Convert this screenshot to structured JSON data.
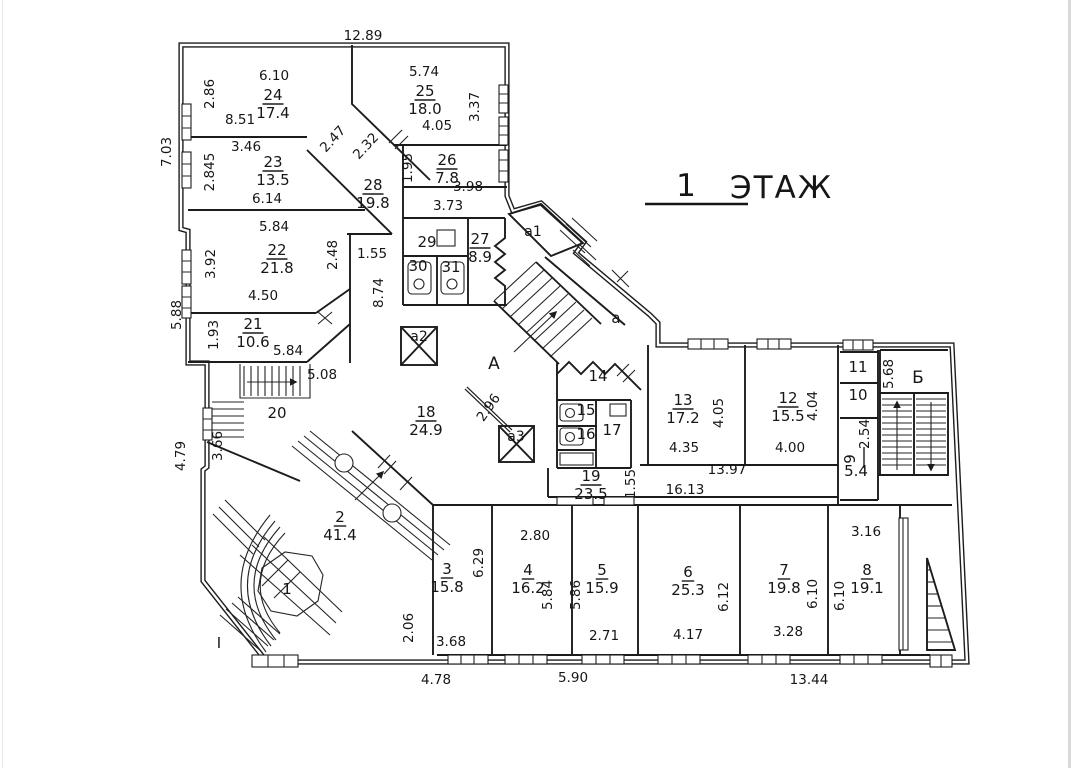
{
  "title": {
    "floor_number": "1",
    "floor_word": "ЭТАЖ"
  },
  "colors": {
    "ink": "#1c1c1c",
    "background": "#ffffff",
    "scan_edge": "#d9d9d9"
  },
  "rooms": [
    {
      "num": "24",
      "area": "17.4",
      "x": 273,
      "y": 100
    },
    {
      "num": "25",
      "area": "18.0",
      "x": 425,
      "y": 96
    },
    {
      "num": "23",
      "area": "13.5",
      "x": 273,
      "y": 167
    },
    {
      "num": "26",
      "area": "7.8",
      "x": 447,
      "y": 165
    },
    {
      "num": "28",
      "area": "19.8",
      "x": 373,
      "y": 190
    },
    {
      "num": "22",
      "area": "21.8",
      "x": 277,
      "y": 255
    },
    {
      "num": "27",
      "area": "8.9",
      "x": 480,
      "y": 244
    },
    {
      "num": "29",
      "x": 427,
      "y": 247
    },
    {
      "num": "30",
      "x": 418,
      "y": 271
    },
    {
      "num": "31",
      "x": 451,
      "y": 272
    },
    {
      "num": "21",
      "area": "10.6",
      "x": 253,
      "y": 329
    },
    {
      "num": "20",
      "x": 277,
      "y": 418
    },
    {
      "num": "18",
      "area": "24.9",
      "x": 426,
      "y": 417
    },
    {
      "num": "14",
      "x": 598,
      "y": 381
    },
    {
      "num": "15",
      "x": 586,
      "y": 415
    },
    {
      "num": "16",
      "x": 586,
      "y": 439
    },
    {
      "num": "17",
      "x": 612,
      "y": 435
    },
    {
      "num": "13",
      "area": "17.2",
      "x": 683,
      "y": 405
    },
    {
      "num": "12",
      "area": "15.5",
      "x": 788,
      "y": 403
    },
    {
      "num": "11",
      "x": 858,
      "y": 372
    },
    {
      "num": "10",
      "x": 858,
      "y": 400
    },
    {
      "num": "9",
      "area": "5.4",
      "x": 855,
      "y": 459,
      "rot": -90
    },
    {
      "num": "19",
      "area": "23.5",
      "x": 591,
      "y": 481
    },
    {
      "num": "2",
      "area": "41.4",
      "x": 340,
      "y": 522
    },
    {
      "num": "1",
      "x": 287,
      "y": 594
    },
    {
      "num": "3",
      "area": "15.8",
      "x": 447,
      "y": 574
    },
    {
      "num": "4",
      "area": "16.2",
      "x": 528,
      "y": 575
    },
    {
      "num": "5",
      "area": "15.9",
      "x": 602,
      "y": 575
    },
    {
      "num": "6",
      "area": "25.3",
      "x": 688,
      "y": 577
    },
    {
      "num": "7",
      "area": "19.8",
      "x": 784,
      "y": 575
    },
    {
      "num": "8",
      "area": "19.1",
      "x": 867,
      "y": 575
    }
  ],
  "zones": [
    {
      "t": "А",
      "x": 494,
      "y": 369,
      "s": 17
    },
    {
      "t": "Б",
      "x": 918,
      "y": 383,
      "s": 17
    },
    {
      "t": "а",
      "x": 616,
      "y": 323,
      "s": 15
    },
    {
      "t": "а1",
      "x": 533,
      "y": 236,
      "s": 14
    },
    {
      "t": "а2",
      "x": 419,
      "y": 341,
      "s": 14
    },
    {
      "t": "а3",
      "x": 516,
      "y": 441,
      "s": 14
    },
    {
      "t": "I",
      "x": 219,
      "y": 648,
      "s": 15
    }
  ],
  "dims": [
    {
      "t": "12.89",
      "x": 363,
      "y": 40,
      "r": 0
    },
    {
      "t": "7.03",
      "x": 171,
      "y": 152,
      "r": -90
    },
    {
      "t": "5.88",
      "x": 181,
      "y": 315,
      "r": -90
    },
    {
      "t": "4.79",
      "x": 185,
      "y": 456,
      "r": -90
    },
    {
      "t": "2.86",
      "x": 214,
      "y": 94,
      "r": -90
    },
    {
      "t": "6.10",
      "x": 274,
      "y": 80,
      "r": 0
    },
    {
      "t": "8.51",
      "x": 240,
      "y": 124,
      "r": 0
    },
    {
      "t": "3.46",
      "x": 246,
      "y": 151,
      "r": 0
    },
    {
      "t": "2.845",
      "x": 214,
      "y": 172,
      "r": -90
    },
    {
      "t": "6.14",
      "x": 267,
      "y": 203,
      "r": 0
    },
    {
      "t": "5.74",
      "x": 424,
      "y": 76,
      "r": 0
    },
    {
      "t": "3.37",
      "x": 479,
      "y": 107,
      "r": -90
    },
    {
      "t": "4.05",
      "x": 437,
      "y": 130,
      "r": 0
    },
    {
      "t": "2.47",
      "x": 336,
      "y": 142,
      "r": -47
    },
    {
      "t": "2.32",
      "x": 369,
      "y": 149,
      "r": -47
    },
    {
      "t": "1.95",
      "x": 412,
      "y": 168,
      "r": -90
    },
    {
      "t": "3.98",
      "x": 468,
      "y": 191,
      "r": 0
    },
    {
      "t": "3.73",
      "x": 448,
      "y": 210,
      "r": 0
    },
    {
      "t": "5.84",
      "x": 274,
      "y": 231,
      "r": 0
    },
    {
      "t": "3.92",
      "x": 215,
      "y": 264,
      "r": -90
    },
    {
      "t": "2.48",
      "x": 337,
      "y": 255,
      "r": -90
    },
    {
      "t": "1.55",
      "x": 372,
      "y": 258,
      "r": 0
    },
    {
      "t": "8.74",
      "x": 383,
      "y": 293,
      "r": -90
    },
    {
      "t": "4.50",
      "x": 263,
      "y": 300,
      "r": 0
    },
    {
      "t": "1.93",
      "x": 218,
      "y": 335,
      "r": -90
    },
    {
      "t": "5.84",
      "x": 288,
      "y": 355,
      "r": 0
    },
    {
      "t": "5.08",
      "x": 322,
      "y": 379,
      "r": 0
    },
    {
      "t": "3.66",
      "x": 222,
      "y": 446,
      "r": -90
    },
    {
      "t": "2.96",
      "x": 492,
      "y": 410,
      "r": -55
    },
    {
      "t": "4.05",
      "x": 723,
      "y": 413,
      "r": -90
    },
    {
      "t": "4.04",
      "x": 817,
      "y": 406,
      "r": -90
    },
    {
      "t": "4.35",
      "x": 684,
      "y": 452,
      "r": 0
    },
    {
      "t": "4.00",
      "x": 790,
      "y": 452,
      "r": 0
    },
    {
      "t": "13.97",
      "x": 727,
      "y": 474,
      "r": 0
    },
    {
      "t": "16.13",
      "x": 685,
      "y": 494,
      "r": 0
    },
    {
      "t": "1.55",
      "x": 635,
      "y": 484,
      "r": -90
    },
    {
      "t": "5.68",
      "x": 893,
      "y": 374,
      "r": -90
    },
    {
      "t": "2.54",
      "x": 869,
      "y": 434,
      "r": -90
    },
    {
      "t": "6.29",
      "x": 483,
      "y": 563,
      "r": -90
    },
    {
      "t": "2.80",
      "x": 535,
      "y": 540,
      "r": 0
    },
    {
      "t": "5.84",
      "x": 552,
      "y": 595,
      "r": -90
    },
    {
      "t": "5.86",
      "x": 580,
      "y": 595,
      "r": -90
    },
    {
      "t": "2.71",
      "x": 604,
      "y": 640,
      "r": 0
    },
    {
      "t": "4.17",
      "x": 688,
      "y": 639,
      "r": 0
    },
    {
      "t": "6.12",
      "x": 728,
      "y": 597,
      "r": -90
    },
    {
      "t": "3.16",
      "x": 866,
      "y": 536,
      "r": 0
    },
    {
      "t": "6.10",
      "x": 817,
      "y": 594,
      "r": -90
    },
    {
      "t": "6.10",
      "x": 844,
      "y": 596,
      "r": -90
    },
    {
      "t": "3.28",
      "x": 788,
      "y": 636,
      "r": 0
    },
    {
      "t": "2.06",
      "x": 413,
      "y": 628,
      "r": -90
    },
    {
      "t": "3.68",
      "x": 451,
      "y": 646,
      "r": 0
    },
    {
      "t": "4.78",
      "x": 436,
      "y": 684,
      "r": 0
    },
    {
      "t": "5.90",
      "x": 573,
      "y": 682,
      "r": 0
    },
    {
      "t": "13.44",
      "x": 809,
      "y": 684,
      "r": 0
    }
  ]
}
